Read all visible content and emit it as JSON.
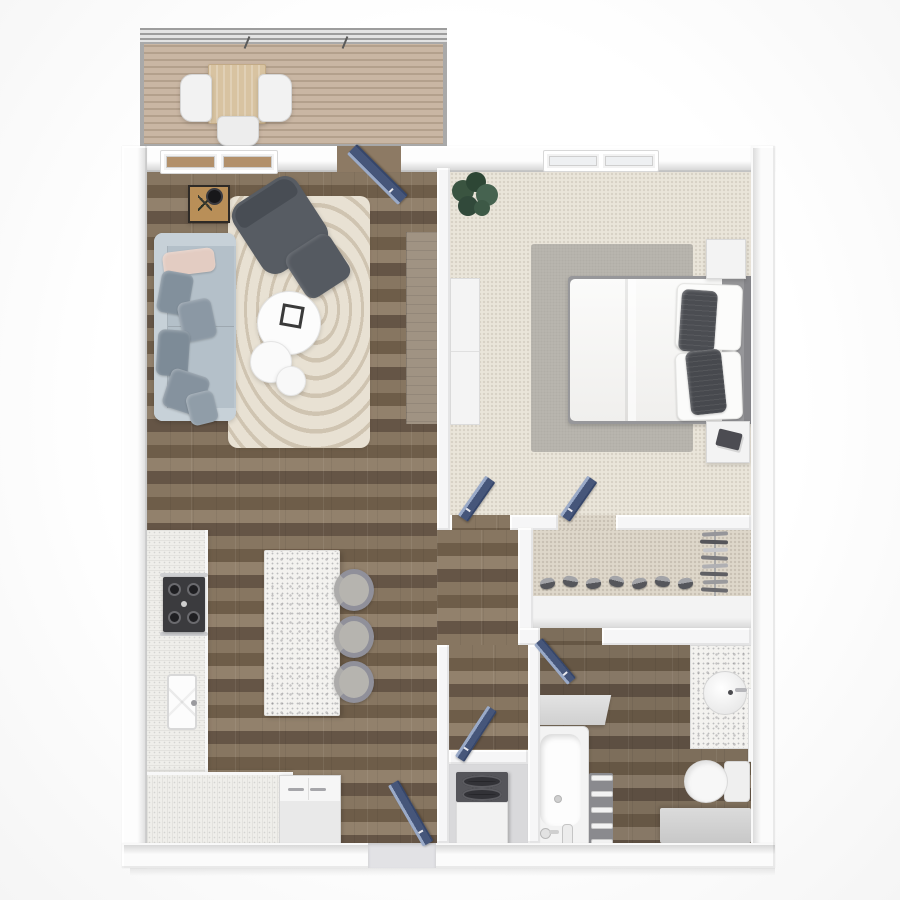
{
  "type": "floor-plan-3d-top-view",
  "rooms": {
    "balcony": {
      "label": "Balcony"
    },
    "living_room": {
      "label": "Living room"
    },
    "bedroom": {
      "label": "Bedroom"
    },
    "kitchen": {
      "label": "Kitchen"
    },
    "hallway": {
      "label": "Hallway"
    },
    "closet": {
      "label": "Walk-in closet"
    },
    "bathroom": {
      "label": "Bathroom"
    },
    "laundry": {
      "label": "Laundry closet"
    },
    "entry": {
      "label": "Entry"
    }
  },
  "items": {
    "patio_table": "Patio table",
    "patio_chair": "Patio chair",
    "patio_bench": "Patio bench",
    "balcony_door": "Balcony door",
    "window": "Window",
    "area_rug": "Swirl area rug",
    "sofa": "Sofa",
    "armchair": "Armchair",
    "ottoman": "Ottoman",
    "coffee_table": "Round coffee table",
    "nesting_table": "Nesting side table",
    "side_table": "Side table with lamp",
    "console": "Console table",
    "bed": "Bed with white duvet",
    "headboard": "Headboard",
    "nightstand": "Nightstand",
    "dresser": "Dresser",
    "bedroom_rug": "Bedroom rug",
    "plant": "Potted plant",
    "door": "Interior door",
    "entry_door": "Entry door",
    "shoes": "Shoe row",
    "hanging_clothes": "Hanging clothes",
    "shelf": "Closet shelf",
    "counter": "Kitchen counter",
    "range": "Range cooktop",
    "kitchen_sink": "Kitchen sink",
    "island": "Kitchen island",
    "bar_stool": "Bar stool",
    "refrigerator": "Refrigerator",
    "washer_dryer": "Stacked washer dryer",
    "bathtub": "Bathtub",
    "towel_shelf": "Towel shelf",
    "bath_ledge": "Bath ledge",
    "vanity": "Vanity with round sink",
    "mirror_door": "Cabinet door",
    "toilet": "Toilet",
    "bath_bench": "Bath step bench"
  },
  "palette": {
    "background": "#ffffff",
    "wall": "#f8f8f8",
    "wall_shadow": "#d2d2d2",
    "wood_floor": "#7b6a57",
    "carpet": "#e9e4da",
    "closet_carpet": "#ded7ca",
    "deck_wood": "#c2ae99",
    "door_navy": "#46567a",
    "sofa_blue_gray": "#bcc7cf",
    "pillow_blush": "#e3ccc2",
    "furniture_dark_gray": "#565b62",
    "rug_living": "#e7e0d2",
    "rug_bedroom": "#b9b6af",
    "counter_terrazzo": "#f2f1ee"
  }
}
